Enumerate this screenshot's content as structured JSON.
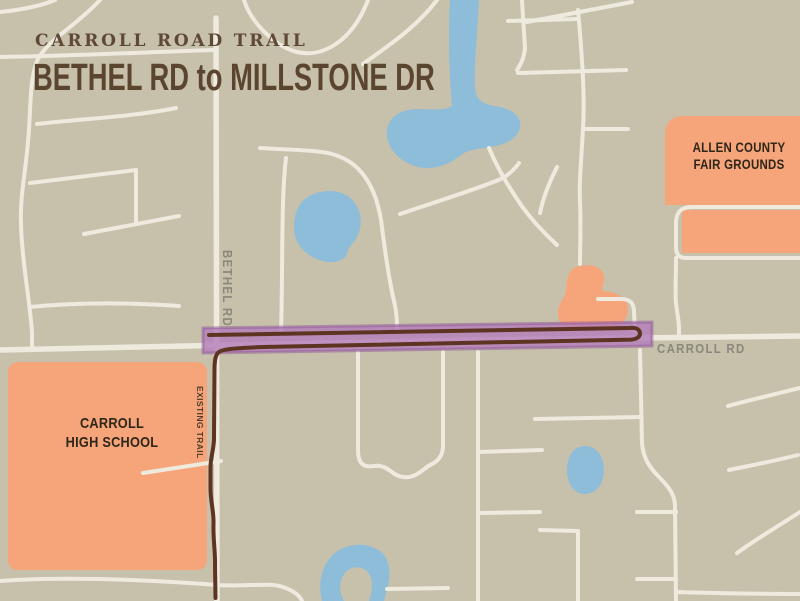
{
  "title": {
    "eyebrow": "CARROLL ROAD TRAIL",
    "main": "BETHEL RD to MILLSTONE DR"
  },
  "labels": {
    "bethel_rd": "BETHEL RD",
    "carroll_rd": "CARROLL RD",
    "existing_trail": "EXISTING TRAIL",
    "school": {
      "line1": "CARROLL",
      "line2": "HIGH SCHOOL"
    },
    "fairgrounds": {
      "line1": "ALLEN COUNTY",
      "line2": "FAIR GROUNDS"
    }
  },
  "colors": {
    "background": "#c7c1ac",
    "road": "#eeeade",
    "water": "#8dbdd9",
    "landmark_orange": "#f6a57b",
    "trail_highlight": "#b47cba",
    "trail_highlight_edge": "#8d5797",
    "trail_line": "#5d3422",
    "title_brown": "#5f4936",
    "subtitle_brown": "#5b452f",
    "road_label_gray": "#8a887b",
    "existing_trail_label": "#513c29",
    "landmark_label": "#2e2619"
  }
}
